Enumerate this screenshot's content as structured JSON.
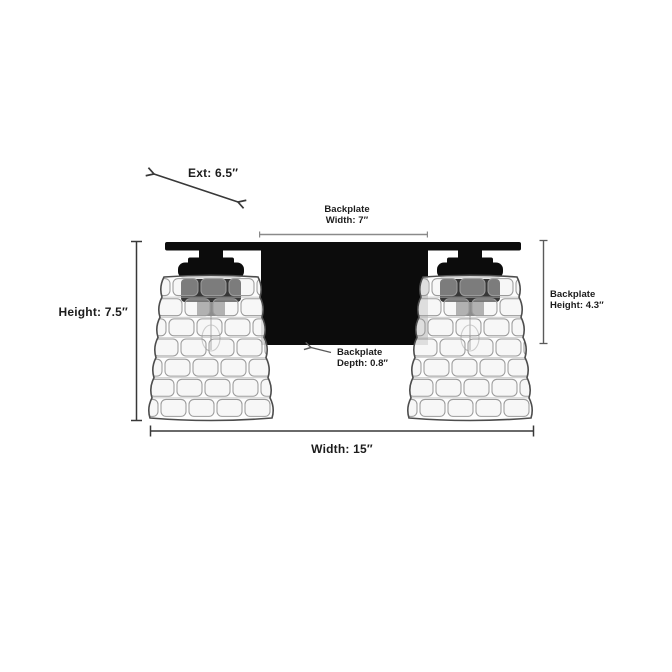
{
  "colors": {
    "background": "#ffffff",
    "fixture_black": "#0c0c0c",
    "glass_fill": "#fdfdfd",
    "glass_stroke": "#4d4d4d",
    "weave_stroke": "#9b9b9b",
    "dimension_line_dark": "#383838",
    "dimension_line_gray": "#8a8a8a",
    "dimension_line_mid": "#5a5a5a",
    "label_text": "#1c1c1c"
  },
  "labels": {
    "ext": "Ext: 6.5″",
    "backplate_width_line1": "Backplate",
    "backplate_width_line2": "Width: 7″",
    "height": "Height: 7.5″",
    "backplate_height_line1": "Backplate",
    "backplate_height_line2": "Height: 4.3″",
    "backplate_depth_line1": "Backplate",
    "backplate_depth_line2": "Depth: 0.8″",
    "width": "Width: 15″"
  },
  "measurements": {
    "extension": {
      "value": 6.5,
      "unit": "in"
    },
    "backplate_width": {
      "value": 7,
      "unit": "in"
    },
    "height": {
      "value": 7.5,
      "unit": "in"
    },
    "backplate_height": {
      "value": 4.3,
      "unit": "in"
    },
    "backplate_depth": {
      "value": 0.8,
      "unit": "in"
    },
    "width": {
      "value": 15,
      "unit": "in"
    }
  },
  "fixture": {
    "num_lights": 2
  }
}
